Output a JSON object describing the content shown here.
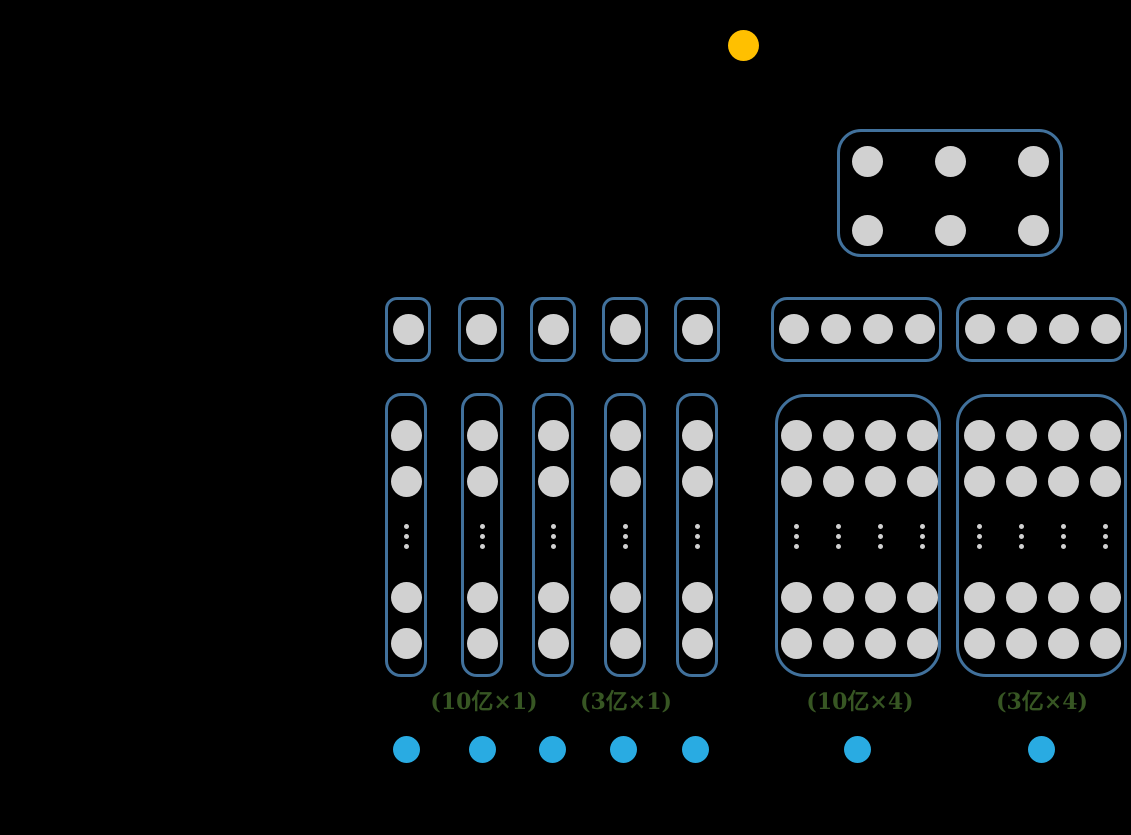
{
  "colors": {
    "background": "#000000",
    "box_border": "#41719C",
    "neuron_fill": "#D1D1D1",
    "input_fill": "#29ABE2",
    "output_fill": "#FFC000",
    "label_green": "#375623"
  },
  "diagram": {
    "output_node": {
      "cx": 743,
      "cy": 45,
      "d": 31
    },
    "aggregate_box": {
      "left": 837,
      "top": 129,
      "width": 226,
      "height": 128,
      "radius": 24,
      "dot_d": 31,
      "col_cx": [
        867,
        950,
        1033
      ],
      "row_cy": [
        161,
        230
      ]
    },
    "embed_row": {
      "cy": 329,
      "boxes": [
        {
          "left": 385,
          "top": 297,
          "width": 46,
          "height": 65,
          "radius": 12,
          "dot_d": 31,
          "col_cx": [
            408
          ]
        },
        {
          "left": 458,
          "top": 297,
          "width": 46,
          "height": 65,
          "radius": 12,
          "dot_d": 31,
          "col_cx": [
            481
          ]
        },
        {
          "left": 530,
          "top": 297,
          "width": 46,
          "height": 65,
          "radius": 12,
          "dot_d": 31,
          "col_cx": [
            553
          ]
        },
        {
          "left": 602,
          "top": 297,
          "width": 46,
          "height": 65,
          "radius": 12,
          "dot_d": 31,
          "col_cx": [
            625
          ]
        },
        {
          "left": 674,
          "top": 297,
          "width": 46,
          "height": 65,
          "radius": 12,
          "dot_d": 31,
          "col_cx": [
            697
          ]
        },
        {
          "left": 771,
          "top": 297,
          "width": 171,
          "height": 65,
          "radius": 16,
          "dot_d": 30,
          "col_cx": [
            794,
            836,
            878,
            920
          ]
        },
        {
          "left": 956,
          "top": 297,
          "width": 171,
          "height": 65,
          "radius": 16,
          "dot_d": 30,
          "col_cx": [
            980,
            1022,
            1064,
            1106
          ]
        }
      ]
    },
    "tower_row": {
      "dot_d": 31,
      "ellipsis_d": 5,
      "neuron_cy": [
        435,
        481,
        597,
        643
      ],
      "ellipsis_cy": [
        526,
        536,
        546
      ],
      "boxes": [
        {
          "left": 385,
          "top": 393,
          "width": 42,
          "height": 284,
          "radius": 16,
          "col_cx": [
            406
          ]
        },
        {
          "left": 461,
          "top": 393,
          "width": 42,
          "height": 284,
          "radius": 16,
          "col_cx": [
            482
          ]
        },
        {
          "left": 532,
          "top": 393,
          "width": 42,
          "height": 284,
          "radius": 16,
          "col_cx": [
            553
          ]
        },
        {
          "left": 604,
          "top": 393,
          "width": 42,
          "height": 284,
          "radius": 16,
          "col_cx": [
            625
          ]
        },
        {
          "left": 676,
          "top": 393,
          "width": 42,
          "height": 284,
          "radius": 16,
          "col_cx": [
            697
          ]
        },
        {
          "left": 775,
          "top": 394,
          "width": 166,
          "height": 283,
          "radius": 30,
          "col_cx": [
            796,
            838,
            880,
            922
          ]
        },
        {
          "left": 956,
          "top": 394,
          "width": 171,
          "height": 283,
          "radius": 30,
          "col_cx": [
            979,
            1021,
            1063,
            1105
          ]
        }
      ]
    },
    "labels": [
      {
        "text": "(10亿×1)",
        "cx": 484,
        "cy": 700
      },
      {
        "text": "(3亿×1)",
        "cx": 626,
        "cy": 700
      },
      {
        "text": "(10亿×4)",
        "cx": 860,
        "cy": 700
      },
      {
        "text": "(3亿×4)",
        "cx": 1042,
        "cy": 700
      }
    ],
    "input_dots": {
      "cy": 749,
      "d": 27,
      "cx": [
        406,
        482,
        552,
        623,
        695,
        857,
        1041
      ]
    }
  }
}
